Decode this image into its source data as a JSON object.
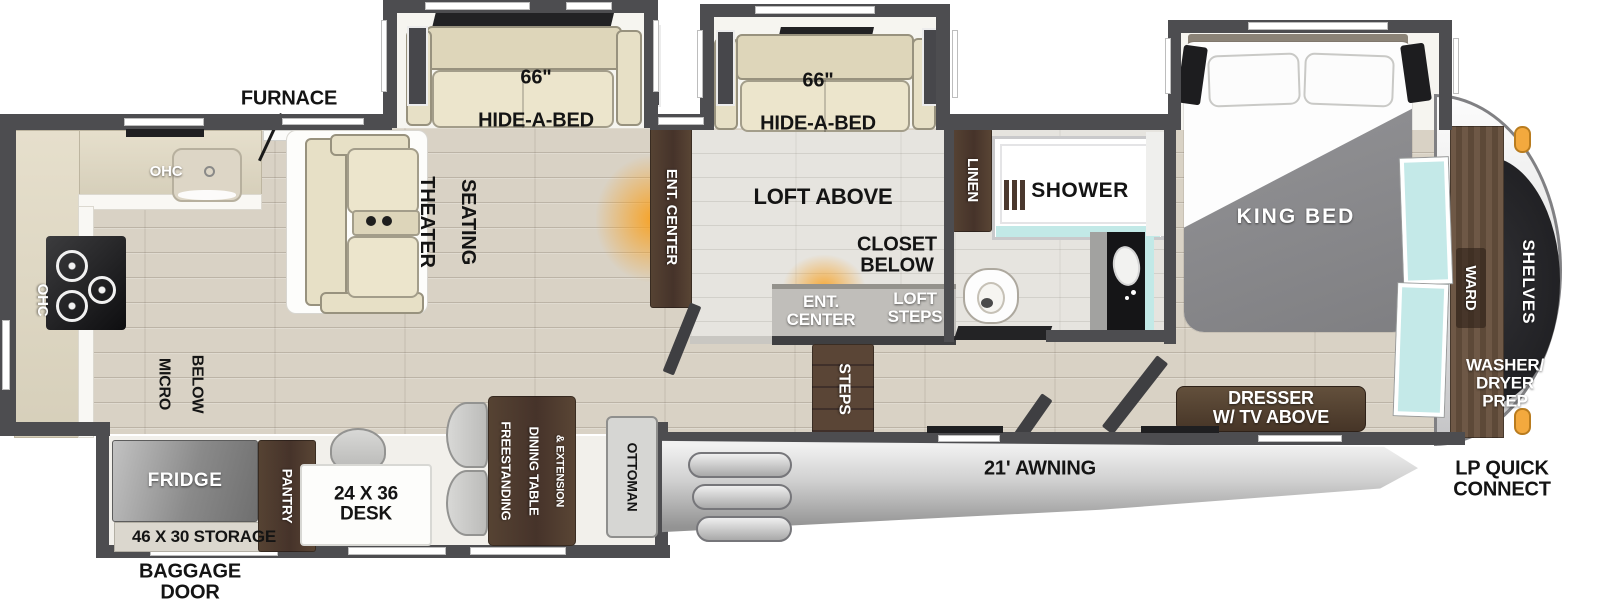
{
  "kitchen": {
    "furnace_label": "FURNACE",
    "ohc_top_label": "OHC",
    "ohc_left_label": "OHC",
    "micro_below_line1": "MICRO",
    "micro_below_line2": "BELOW"
  },
  "living_room": {
    "hide_a_bed_left_size": "66\"",
    "hide_a_bed_left_label": "HIDE-A-BED",
    "hide_a_bed_right_size": "66\"",
    "hide_a_bed_right_label": "HIDE-A-BED",
    "theater_seating_line1": "THEATER",
    "theater_seating_line2": "SEATING",
    "ent_center_label": "ENT. CENTER"
  },
  "loft": {
    "loft_above_label": "LOFT ABOVE",
    "closet_below_label": "CLOSET\nBELOW",
    "ent_center_label": "ENT.\nCENTER",
    "loft_steps_label": "LOFT\nSTEPS",
    "steps_label": "STEPS"
  },
  "bathroom": {
    "linen_label": "LINEN",
    "shower_label": "SHOWER"
  },
  "bedroom": {
    "king_bed_label": "KING BED",
    "dresser_label": "DRESSER\nW/ TV ABOVE",
    "ward_label": "WARD",
    "washer_dryer_label": "WASHER/\nDRYER\nPREP"
  },
  "front_cap": {
    "shelves_label": "SHELVES",
    "lp_quick_connect_label": "LP QUICK\nCONNECT"
  },
  "door_side_slide": {
    "fridge_label": "FRIDGE",
    "storage_label": "46 X 30 STORAGE",
    "pantry_label": "PANTRY",
    "desk_label": "24 X 36\nDESK",
    "dining_table_line1": "FREESTANDING",
    "dining_table_line2": "DINING TABLE",
    "dining_table_line3": "& EXTENSION",
    "ottoman_label": "OTTOMAN"
  },
  "exterior": {
    "awning_label": "21' AWNING",
    "baggage_door_label": "BAGGAGE\nDOOR"
  }
}
